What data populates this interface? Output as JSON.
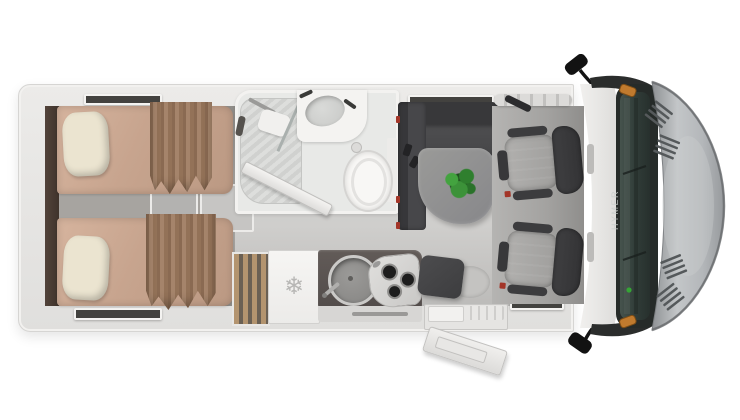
{
  "scene": {
    "description": "Top-down interior floor plan render of a motorhome",
    "background_color": "#ffffff"
  },
  "branding": {
    "cab_text": "HYMER"
  },
  "icons": {
    "snowflake": "❄"
  },
  "colors": {
    "body_wall": "#e9e8e6",
    "floor": "#c9c8c6",
    "bedroom_floor": "#a6a39f",
    "mattress_tan": "#c9a68f",
    "pillow_cream": "#ece5d1",
    "curtain_brown": "#97775f",
    "upholstery_charcoal": "#48484a",
    "table_gray": "#90908e",
    "plant_green": "#3b9338",
    "counter_dark": "#595351",
    "fridge_white": "#f4f3f1",
    "hood_silver": "#b2b5b8",
    "windshield_green": "#36403d",
    "indicator_orange": "#c07a2e",
    "seatbelt_red": "#a33528"
  },
  "areas": {
    "bedroom": "twin-single-beds",
    "bathroom": "shower-toilet-vanity",
    "kitchen": "wardrobe-fridge-sink-hob",
    "lounge": "l-sofa-table-plant",
    "cab": "two-swivel-seats-dashboard"
  }
}
